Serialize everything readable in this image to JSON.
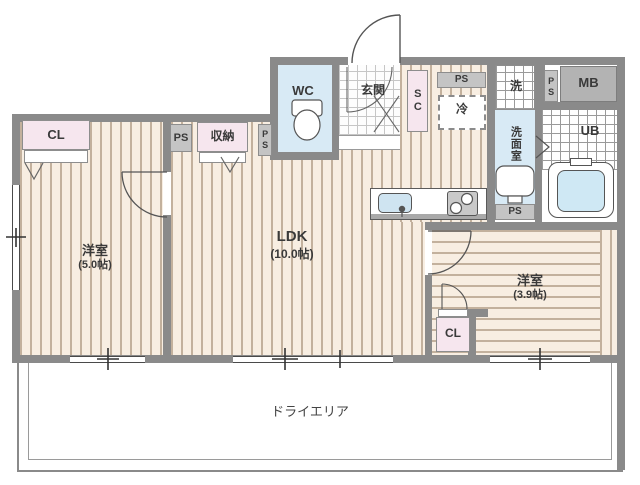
{
  "title": "apartment-floor-plan",
  "rooms": {
    "left": {
      "name": "洋室",
      "size": "(5.0帖)"
    },
    "ldk": {
      "name": "LDK",
      "size": "(10.0帖)"
    },
    "right": {
      "name": "洋室",
      "size": "(3.9帖)"
    }
  },
  "labels": {
    "cl_left": "CL",
    "ps_top_left": "PS",
    "shuno": "収納",
    "ps_vert_left": "PS",
    "wc": "WC",
    "genkan": "玄関",
    "sc": "SC",
    "ps_top_center": "PS",
    "rei": "冷",
    "sen": "洗",
    "senmenshitsu": "洗面室",
    "ps_vert_right": "PS",
    "mb": "MB",
    "ub": "UB",
    "ps_bottom": "PS",
    "cl_right": "CL",
    "dry_area": "ドライエリア"
  },
  "colors": {
    "wall": "#8a8a8a",
    "floor_cream": "#f8eee2",
    "floor_stripe": "#c3b19d",
    "room_blue": "#d8eaf5",
    "closet_pink": "#f6e6ee",
    "box_gray": "#c4c4c4",
    "mb_gray": "#b3b3b3",
    "tub_blue": "#cfe8f4",
    "sink_blue": "#cfe4f1"
  }
}
